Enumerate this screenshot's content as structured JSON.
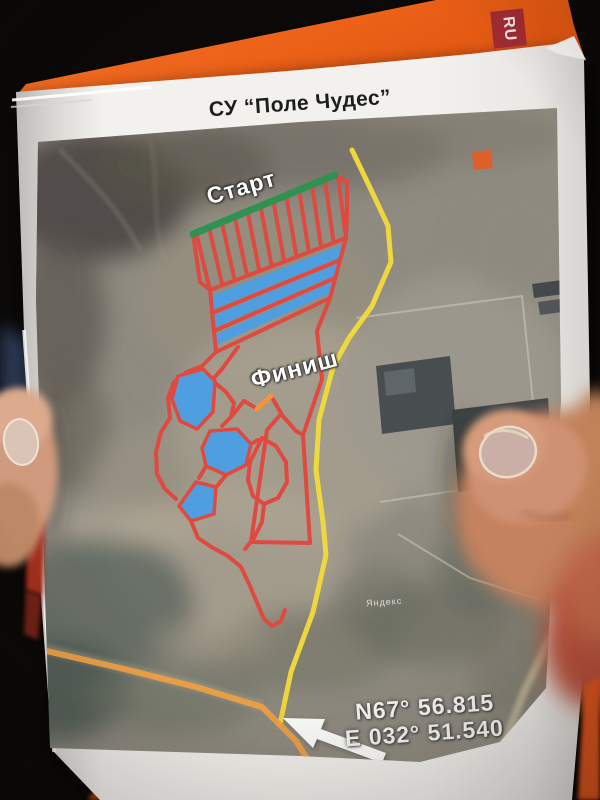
{
  "scene": {
    "description": "Photograph of a printed rally special-stage satellite map held in hands over an orange folder"
  },
  "folder": {
    "logo_text": "RU",
    "color": "#ee6418",
    "logo_bg": "#a12b33"
  },
  "page": {
    "title": "СУ “Поле Чудес”"
  },
  "map": {
    "labels": {
      "start": "Старт",
      "finish": "Финиш"
    },
    "coordinates": {
      "latitude": "N67° 56.815",
      "longitude": "E 032° 51.540"
    },
    "watermark": "Яндекс",
    "colors": {
      "track_outline": "#e0493f",
      "water": "#4f9fe0",
      "start_line": "#2f9152",
      "route_line": "#f2d93c",
      "road_line": "#efa044",
      "finish_gate": "#f0953e"
    }
  }
}
